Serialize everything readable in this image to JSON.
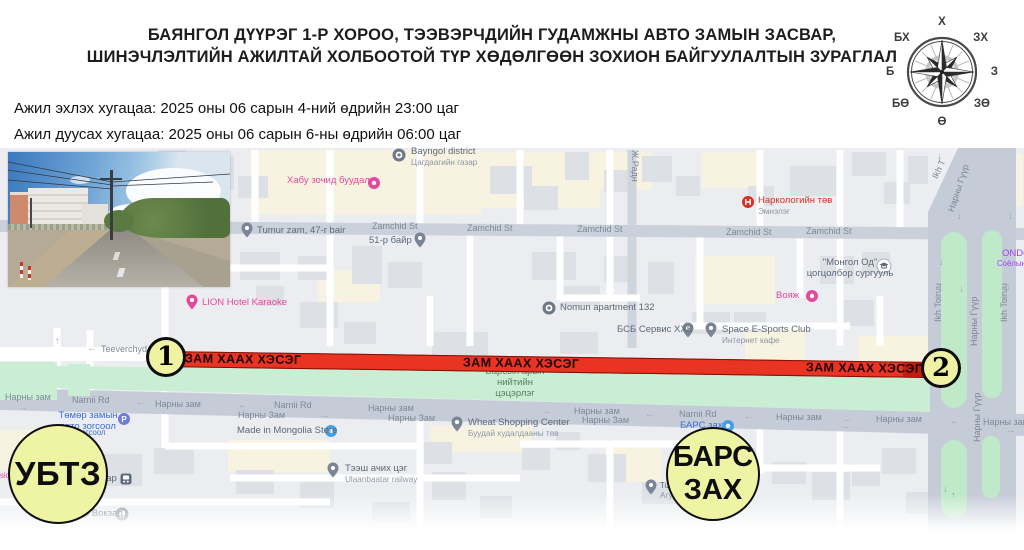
{
  "title": {
    "line1": "БАЯНГОЛ ДҮҮРЭГ 1-Р ХОРОО, ТЭЭВЭРЧДИЙН ГУДАМЖНЫ АВТО ЗАМЫН ЗАСВАР,",
    "line2": "ШИНЭЧЛЭЛТИЙН АЖИЛТАЙ ХОЛБООТОЙ ТҮР ХӨДӨЛГӨӨН ЗОХИОН БАЙГУУЛАЛТЫН ЗУРАГЛАЛ"
  },
  "schedule": {
    "start_label": "Ажил эхлэх хугацаа: 2025 оны 06 сарын 4-ний өдрийн 23:00 цаг",
    "end_label": "Ажил дуусах хугацаа: 2025 оны 06 сарын 6-ны өдрийн 06:00 цаг"
  },
  "compass": {
    "n": "Х",
    "s": "Ө",
    "e": "З",
    "w": "Б",
    "ne": "ЗХ",
    "nw": "БХ",
    "se": "ЗӨ",
    "sw": "БӨ"
  },
  "closure": {
    "band_label": "ЗАМ ХААХ ХЭСЭГ",
    "point1": "1",
    "point2": "2",
    "band_color": "#e93323",
    "marker_fill": "#eef2a2"
  },
  "badges": {
    "ubtz": "УБТЗ",
    "bars_line1": "БАРС",
    "bars_line2": "ЗАХ"
  },
  "map": {
    "labels": [
      {
        "t": "Хабу зочид буудал",
        "c": "pink",
        "x": 287,
        "y": 176,
        "i": "circle-pink",
        "ix": 374,
        "iy": 183
      },
      {
        "t": "Bayngol district",
        "s": "Цагдаагийн газар",
        "c": "poi",
        "x": 411,
        "y": 147,
        "i": "circle-badge",
        "ix": 399,
        "iy": 155
      },
      {
        "t": "Tumur zam, 47-r bair",
        "c": "poi",
        "x": 257,
        "y": 226,
        "i": "pin",
        "ix": 247,
        "iy": 230
      },
      {
        "t": "51-р байр",
        "c": "poi",
        "x": 369,
        "y": 236,
        "i": "pin",
        "ix": 420,
        "iy": 240
      },
      {
        "t": "Ж.Радн",
        "c": "road",
        "x": 640,
        "y": 150,
        "r": 90
      },
      {
        "t": "Zamchid St",
        "c": "road",
        "x": 372,
        "y": 221
      },
      {
        "t": "Zamchid St",
        "c": "road",
        "x": 467,
        "y": 223
      },
      {
        "t": "Zamchid St",
        "c": "road",
        "x": 577,
        "y": 224
      },
      {
        "t": "Zamchid St",
        "c": "road",
        "x": 726,
        "y": 227
      },
      {
        "t": "Zamchid St",
        "c": "road",
        "x": 806,
        "y": 226
      },
      {
        "t": "Наркологийн төв",
        "s": "Эмнэлэг",
        "c": "red",
        "x": 758,
        "y": 196,
        "i": "h-red",
        "ix": 748,
        "iy": 202
      },
      {
        "t": "LION Hotel Karaoke",
        "c": "pink",
        "x": 202,
        "y": 298,
        "i": "pin-pink",
        "ix": 192,
        "iy": 302
      },
      {
        "t": "Nomun apartment 132",
        "c": "poi",
        "x": 560,
        "y": 303,
        "i": "circle-badge",
        "ix": 549,
        "iy": 308
      },
      {
        "t": "\"Монгол Од\"\nцогцолбор сургууль",
        "c": "poi center",
        "x": 850,
        "y": 258,
        "i": "school",
        "ix": 884,
        "iy": 266
      },
      {
        "t": "Вояж",
        "c": "pink",
        "x": 776,
        "y": 291,
        "i": "circle-pink",
        "ix": 812,
        "iy": 296
      },
      {
        "t": "ONDC",
        "c": "purple",
        "x": 1002,
        "y": 249
      },
      {
        "t": "Соёлын төв",
        "c": "purple sm",
        "x": 997,
        "y": 260
      },
      {
        "t": "БСБ Сервис ХХК",
        "c": "poi",
        "x": 617,
        "y": 325,
        "i": "pin",
        "ix": 688,
        "iy": 330
      },
      {
        "t": "Space E-Sports Club",
        "s": "Интернет кафе",
        "c": "poi",
        "x": 722,
        "y": 325,
        "i": "pin",
        "ix": 711,
        "iy": 330
      },
      {
        "t": "Teeverchyd",
        "c": "road",
        "x": 101,
        "y": 344
      },
      {
        "t": "←",
        "c": "arrow",
        "x": 87,
        "y": 344
      },
      {
        "t": "Барсын арын\nнийтийн\nцэцэрлэг",
        "c": "park center",
        "x": 515,
        "y": 367
      },
      {
        "t": "Нарны зам",
        "c": "road",
        "x": 5,
        "y": 392
      },
      {
        "t": "→",
        "c": "arrow",
        "x": 18,
        "y": 403
      },
      {
        "t": "Narnii Rd",
        "c": "road",
        "x": 72,
        "y": 395
      },
      {
        "t": "←",
        "c": "arrow",
        "x": 136,
        "y": 398
      },
      {
        "t": "Нарны зам",
        "c": "road",
        "x": 155,
        "y": 399
      },
      {
        "t": "←",
        "c": "arrow",
        "x": 238,
        "y": 401
      },
      {
        "t": "Narnii Rd",
        "c": "road",
        "x": 274,
        "y": 400
      },
      {
        "t": "Нарны Зам",
        "c": "road",
        "x": 238,
        "y": 410
      },
      {
        "t": "→",
        "c": "arrow",
        "x": 320,
        "y": 411
      },
      {
        "t": "Нарны зам",
        "c": "road",
        "x": 368,
        "y": 403
      },
      {
        "t": "Нарны Зам",
        "c": "road",
        "x": 388,
        "y": 413
      },
      {
        "t": "←",
        "c": "arrow",
        "x": 543,
        "y": 407
      },
      {
        "t": "Нарны зам",
        "c": "road",
        "x": 574,
        "y": 406
      },
      {
        "t": "Нарны Зам",
        "c": "road",
        "x": 582,
        "y": 415
      },
      {
        "t": "←",
        "c": "arrow",
        "x": 645,
        "y": 410
      },
      {
        "t": "Narnii Rd",
        "c": "road",
        "x": 679,
        "y": 409
      },
      {
        "t": "←",
        "c": "arrow",
        "x": 744,
        "y": 412
      },
      {
        "t": "Нарны зам",
        "c": "road",
        "x": 776,
        "y": 412
      },
      {
        "t": "←",
        "c": "arrow",
        "x": 843,
        "y": 415
      },
      {
        "t": "→",
        "c": "arrow",
        "x": 840,
        "y": 422
      },
      {
        "t": "Нарны зам",
        "c": "road",
        "x": 876,
        "y": 414
      },
      {
        "t": "←",
        "c": "arrow",
        "x": 950,
        "y": 417
      },
      {
        "t": "Нарны зам",
        "c": "road",
        "x": 983,
        "y": 417
      },
      {
        "t": "→",
        "c": "arrow",
        "x": 1006,
        "y": 426
      },
      {
        "t": "БАРС зах",
        "c": "blue",
        "x": 680,
        "y": 421,
        "i": "circle-blue",
        "ix": 728,
        "iy": 426
      },
      {
        "t": "Wheat Shopping Center",
        "s": "Буудай худалдааны төв",
        "c": "poi",
        "x": 468,
        "y": 418,
        "i": "pin",
        "ix": 457,
        "iy": 424
      },
      {
        "t": "Made in Mongolia Store",
        "c": "poi",
        "x": 237,
        "y": 426,
        "i": "circle-blue",
        "ix": 331,
        "iy": 431
      },
      {
        "t": "Төмөр замын\nавто зогсоол",
        "c": "blue center",
        "x": 88,
        "y": 411,
        "i": "p-blue",
        "ix": 124,
        "iy": 419
      },
      {
        "t": "зогсоол",
        "c": "blue sm",
        "x": 78,
        "y": 429
      },
      {
        "t": "Тээш ачих цэг",
        "s": "Ulaanbaatar railway",
        "c": "poi",
        "x": 345,
        "y": 464,
        "i": "pin",
        "ix": 333,
        "iy": 470
      },
      {
        "t": "тар",
        "c": "poi",
        "x": 102,
        "y": 474,
        "i": "train",
        "ix": 126,
        "iy": 479
      },
      {
        "t": "Tu",
        "s": "Агуу",
        "c": "poi sm",
        "x": 660,
        "y": 482,
        "i": "pin",
        "ix": 651,
        "iy": 487
      },
      {
        "t": "Улаанбаатар Вокзал",
        "c": "poi",
        "x": 32,
        "y": 509,
        "i": "circle-gray",
        "ix": 122,
        "iy": 514
      },
      {
        "t": "sic",
        "c": "pink sm",
        "x": 0,
        "y": 472
      },
      {
        "t": "Ikh T",
        "c": "road",
        "x": 930,
        "y": 176,
        "r": -65
      },
      {
        "t": "Нарны Гүүр",
        "c": "road",
        "x": 946,
        "y": 210,
        "r": -72
      },
      {
        "t": "Ikh Toiruu",
        "c": "road",
        "x": 933,
        "y": 322,
        "r": -90
      },
      {
        "t": "Нарны Гүүр",
        "c": "road",
        "x": 969,
        "y": 346,
        "r": -90
      },
      {
        "t": "Ikh Toiruu",
        "c": "road",
        "x": 999,
        "y": 322,
        "r": -90
      },
      {
        "t": "Нарны Гүүр",
        "c": "road",
        "x": 972,
        "y": 442,
        "r": -90
      },
      {
        "t": "↓",
        "c": "arrow",
        "x": 937,
        "y": 152
      },
      {
        "t": "↓",
        "c": "arrow",
        "x": 957,
        "y": 212
      },
      {
        "t": "↓",
        "c": "arrow",
        "x": 1008,
        "y": 212
      },
      {
        "t": "↓",
        "c": "arrow",
        "x": 939,
        "y": 258
      },
      {
        "t": "↓",
        "c": "arrow",
        "x": 959,
        "y": 285
      },
      {
        "t": "↓",
        "c": "arrow",
        "x": 1006,
        "y": 283
      },
      {
        "t": "↑",
        "c": "arrow",
        "x": 161,
        "y": 370
      },
      {
        "t": "↑",
        "c": "arrow",
        "x": 55,
        "y": 337
      },
      {
        "t": "↓",
        "c": "arrow",
        "x": 943,
        "y": 485
      },
      {
        "t": "↑",
        "c": "arrow",
        "x": 951,
        "y": 491
      }
    ]
  }
}
